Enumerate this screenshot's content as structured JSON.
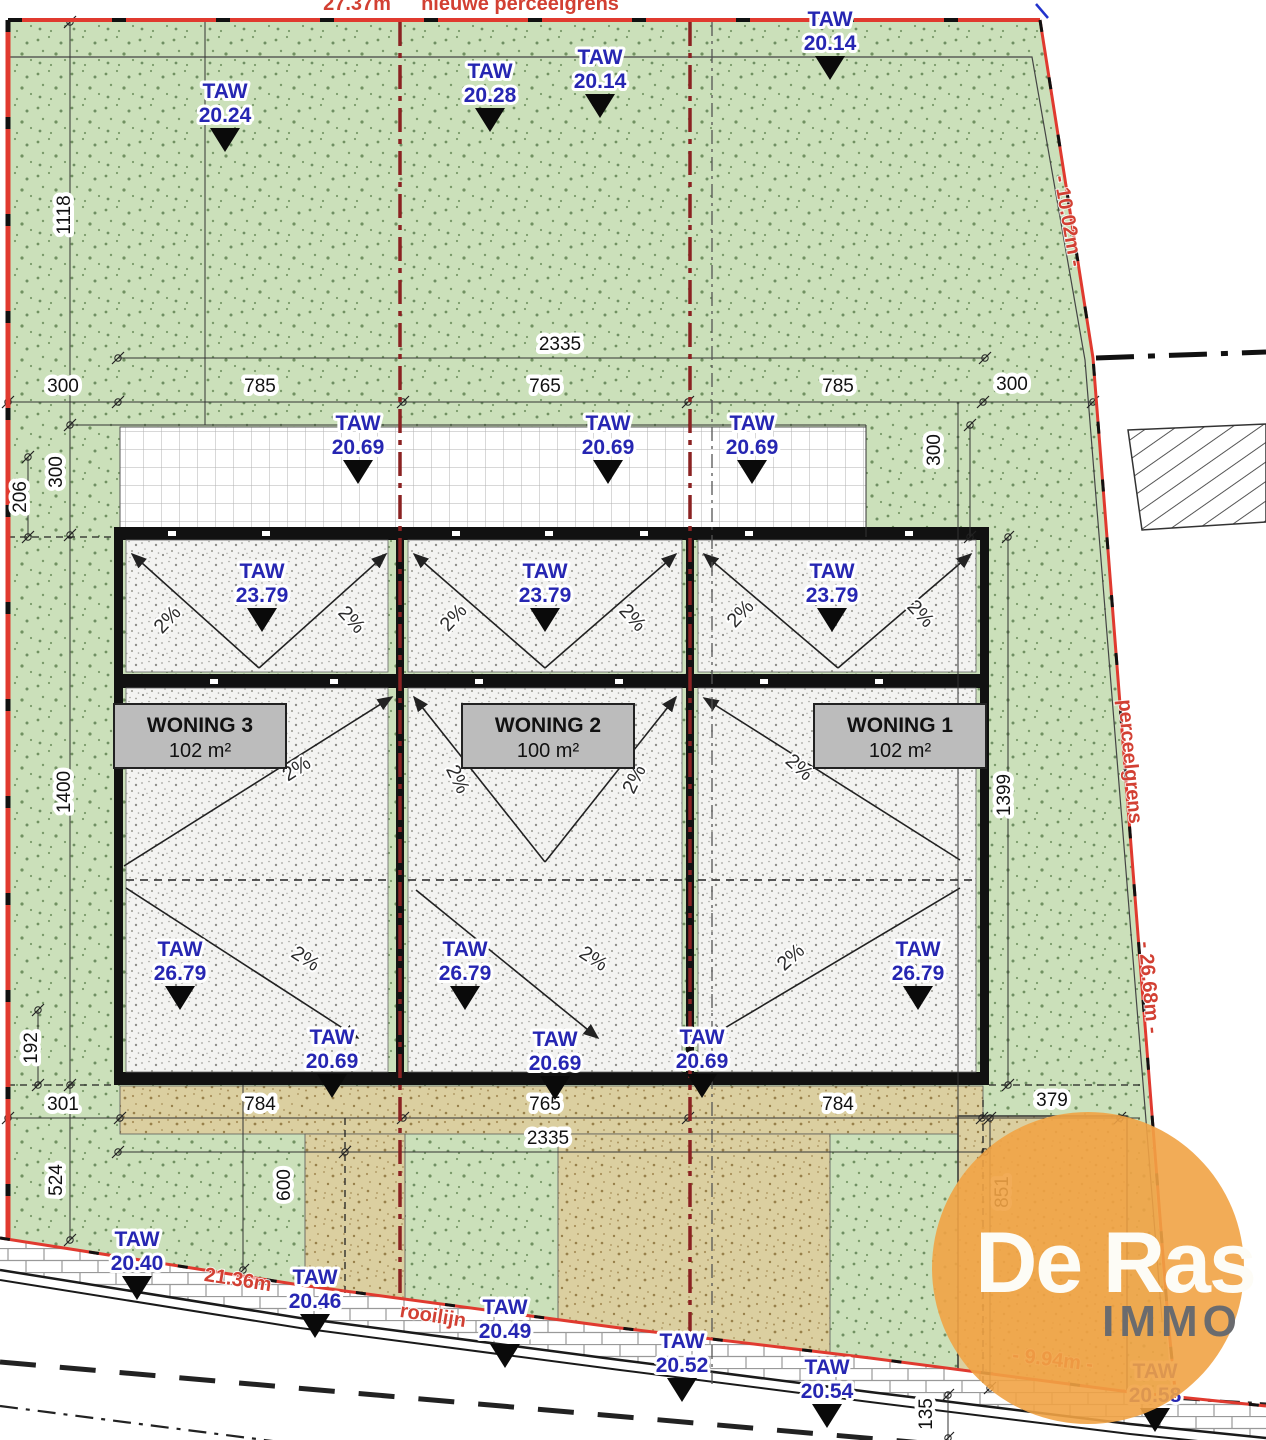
{
  "plan": {
    "taw_label": "TAW",
    "taw_markers": [
      {
        "value": "20.24",
        "x": 225,
        "y": 80
      },
      {
        "value": "20.28",
        "x": 490,
        "y": 60
      },
      {
        "value": "20.14",
        "x": 600,
        "y": 46
      },
      {
        "value": "20.14",
        "x": 830,
        "y": 8
      },
      {
        "value": "20.69",
        "x": 358,
        "y": 412
      },
      {
        "value": "20.69",
        "x": 608,
        "y": 412
      },
      {
        "value": "20.69",
        "x": 752,
        "y": 412
      },
      {
        "value": "23.79",
        "x": 262,
        "y": 560
      },
      {
        "value": "23.79",
        "x": 545,
        "y": 560
      },
      {
        "value": "23.79",
        "x": 832,
        "y": 560
      },
      {
        "value": "26.79",
        "x": 180,
        "y": 938
      },
      {
        "value": "26.79",
        "x": 465,
        "y": 938
      },
      {
        "value": "26.79",
        "x": 918,
        "y": 938
      },
      {
        "value": "20.69",
        "x": 332,
        "y": 1026
      },
      {
        "value": "20.69",
        "x": 555,
        "y": 1028
      },
      {
        "value": "20.69",
        "x": 702,
        "y": 1026
      },
      {
        "value": "20.40",
        "x": 137,
        "y": 1228
      },
      {
        "value": "20.46",
        "x": 315,
        "y": 1266
      },
      {
        "value": "20.49",
        "x": 505,
        "y": 1296
      },
      {
        "value": "20.52",
        "x": 682,
        "y": 1330
      },
      {
        "value": "20.54",
        "x": 827,
        "y": 1356
      },
      {
        "value": "20.58",
        "x": 1155,
        "y": 1360
      }
    ],
    "houses": [
      {
        "name": "WONING 3",
        "area": "102 m²"
      },
      {
        "name": "WONING 2",
        "area": "100 m²"
      },
      {
        "name": "WONING 1",
        "area": "102 m²"
      }
    ],
    "slope_labels": [
      {
        "text": "2%",
        "x": 172,
        "y": 624,
        "rot": -47
      },
      {
        "text": "2%",
        "x": 347,
        "y": 624,
        "rot": 47
      },
      {
        "text": "2%",
        "x": 458,
        "y": 622,
        "rot": -47
      },
      {
        "text": "2%",
        "x": 628,
        "y": 622,
        "rot": 47
      },
      {
        "text": "2%",
        "x": 745,
        "y": 618,
        "rot": -47
      },
      {
        "text": "2%",
        "x": 916,
        "y": 618,
        "rot": 47
      },
      {
        "text": "2%",
        "x": 300,
        "y": 774,
        "rot": -33
      },
      {
        "text": "2%",
        "x": 452,
        "y": 782,
        "rot": 64
      },
      {
        "text": "2%",
        "x": 640,
        "y": 782,
        "rot": -64
      },
      {
        "text": "2%",
        "x": 795,
        "y": 772,
        "rot": 42
      },
      {
        "text": "2%",
        "x": 302,
        "y": 964,
        "rot": 33
      },
      {
        "text": "2%",
        "x": 590,
        "y": 964,
        "rot": 33
      },
      {
        "text": "2%",
        "x": 795,
        "y": 962,
        "rot": -42
      }
    ],
    "dim_labels": [
      {
        "text": "2335",
        "x": 560,
        "y": 350,
        "rot": 0
      },
      {
        "text": "300",
        "x": 63,
        "y": 392,
        "rot": 0
      },
      {
        "text": "785",
        "x": 260,
        "y": 392,
        "rot": 0
      },
      {
        "text": "765",
        "x": 545,
        "y": 392,
        "rot": 0
      },
      {
        "text": "785",
        "x": 838,
        "y": 392,
        "rot": 0
      },
      {
        "text": "300",
        "x": 1012,
        "y": 390,
        "rot": 0
      },
      {
        "text": "1118",
        "x": 70,
        "y": 215,
        "rot": -90
      },
      {
        "text": "300",
        "x": 62,
        "y": 472,
        "rot": -90
      },
      {
        "text": "206",
        "x": 26,
        "y": 497,
        "rot": -90
      },
      {
        "text": "300",
        "x": 940,
        "y": 450,
        "rot": -90
      },
      {
        "text": "1400",
        "x": 70,
        "y": 792,
        "rot": -90
      },
      {
        "text": "1399",
        "x": 1010,
        "y": 795,
        "rot": -90
      },
      {
        "text": "192",
        "x": 37,
        "y": 1048,
        "rot": -90
      },
      {
        "text": "301",
        "x": 63,
        "y": 1110,
        "rot": 0
      },
      {
        "text": "784",
        "x": 260,
        "y": 1110,
        "rot": 0
      },
      {
        "text": "765",
        "x": 545,
        "y": 1110,
        "rot": 0
      },
      {
        "text": "784",
        "x": 838,
        "y": 1110,
        "rot": 0
      },
      {
        "text": "379",
        "x": 1052,
        "y": 1106,
        "rot": 0
      },
      {
        "text": "2335",
        "x": 548,
        "y": 1144,
        "rot": 0
      },
      {
        "text": "524",
        "x": 62,
        "y": 1180,
        "rot": -90
      },
      {
        "text": "600",
        "x": 290,
        "y": 1185,
        "rot": -90
      },
      {
        "text": "851",
        "x": 1008,
        "y": 1192,
        "rot": -90
      },
      {
        "text": "135",
        "x": 932,
        "y": 1414,
        "rot": -90
      }
    ],
    "boundary_labels": [
      {
        "text": "27.37m",
        "x": 357,
        "y": 10,
        "rot": 0
      },
      {
        "text": "nieuwe perceelgrens",
        "x": 520,
        "y": 10,
        "rot": 0
      },
      {
        "text": "- 10.02m -",
        "x": 1062,
        "y": 222,
        "rot": 80
      },
      {
        "text": "perceelgrens",
        "x": 1124,
        "y": 762,
        "rot": 85
      },
      {
        "text": "- 26.68m -",
        "x": 1143,
        "y": 988,
        "rot": 85
      },
      {
        "text": "21.36m",
        "x": 237,
        "y": 1286,
        "rot": 9
      },
      {
        "text": "rooilijn",
        "x": 432,
        "y": 1322,
        "rot": 9
      },
      {
        "text": "- 9.94m -",
        "x": 1052,
        "y": 1366,
        "rot": 7
      }
    ],
    "logo": {
      "line1": "De Ras",
      "line2": "IMMO"
    },
    "colors": {
      "boundary_red": "#e03a2f",
      "parcel_split_red": "#8b2222",
      "taw_blue": "#2626b2",
      "green": "#cbe0ba",
      "tan": "#dbcfa0",
      "roof": "#f3f3f1",
      "logo_orange": "#f1a345",
      "logo_gray": "#6a6b6e"
    }
  }
}
